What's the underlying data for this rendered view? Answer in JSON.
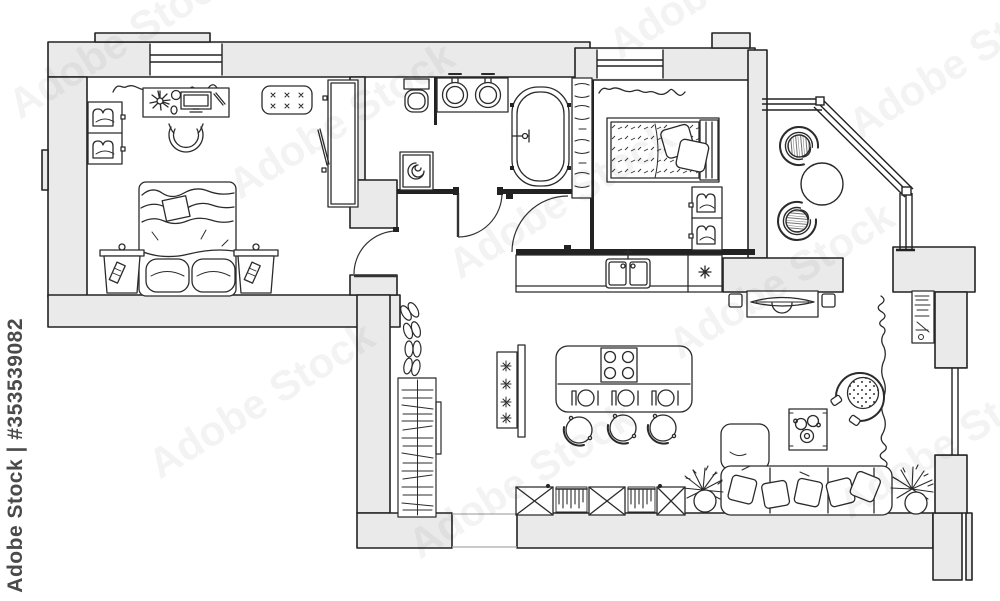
{
  "image": {
    "kind": "stock image of an architectural floor plan, apartment top view, black-and-white line drawing",
    "width_px": 1000,
    "height_px": 601
  },
  "watermark": {
    "brand": "Adobe Stock",
    "stock_id": "#353539082",
    "full": "Adobe Stock | #353539082"
  },
  "colors": {
    "background": "#ffffff",
    "wall_fill": "#eaeaea",
    "line": "#222222",
    "watermark_side": "#4a4a4a",
    "watermark_diagonal_opacity": "0.05"
  },
  "plan": {
    "type": "apartment floor plan, top view",
    "rooms": [
      {
        "name": "Bedroom 1",
        "furniture": [
          "double bed with blanket",
          "bedside table left",
          "bedside table right",
          "desk with monitor, flower and cup",
          "desk chair",
          "tufted ottoman",
          "tall wardrobe with open door",
          "two-cell shelf unit",
          "window",
          "curtain"
        ]
      },
      {
        "name": "Bathroom",
        "furniture": [
          "toilet",
          "vanity with two round sinks",
          "bathtub",
          "washing machine",
          "towel shelf rack"
        ]
      },
      {
        "name": "Hallway",
        "furniture": [
          "open wardrobe with clothes on hangers",
          "four pairs of shoes",
          "entrance opening"
        ]
      },
      {
        "name": "Bedroom 2",
        "furniture": [
          "single bed with patterned blanket and pillows",
          "two-cell shelf unit",
          "window",
          "curtain"
        ]
      },
      {
        "name": "Balcony",
        "furniture": [
          "wicker chair top",
          "wicker chair bottom",
          "round table",
          "glazed panoramic windows"
        ]
      },
      {
        "name": "Kitchen",
        "furniture": [
          "counter with double sink",
          "counter cell with star symbol",
          "island with 4-burner cooktop",
          "three place settings",
          "three bar stools",
          "plant stand with flowers"
        ]
      },
      {
        "name": "Living room",
        "furniture": [
          "corner sofa with five pillows",
          "round swivel armchair",
          "coffee table with cups",
          "TV on stand",
          "two speakers",
          "bookshelf",
          "potted plant left",
          "potted plant right",
          "two radiators",
          "three crossed cabinets",
          "window",
          "curtain"
        ]
      }
    ]
  }
}
